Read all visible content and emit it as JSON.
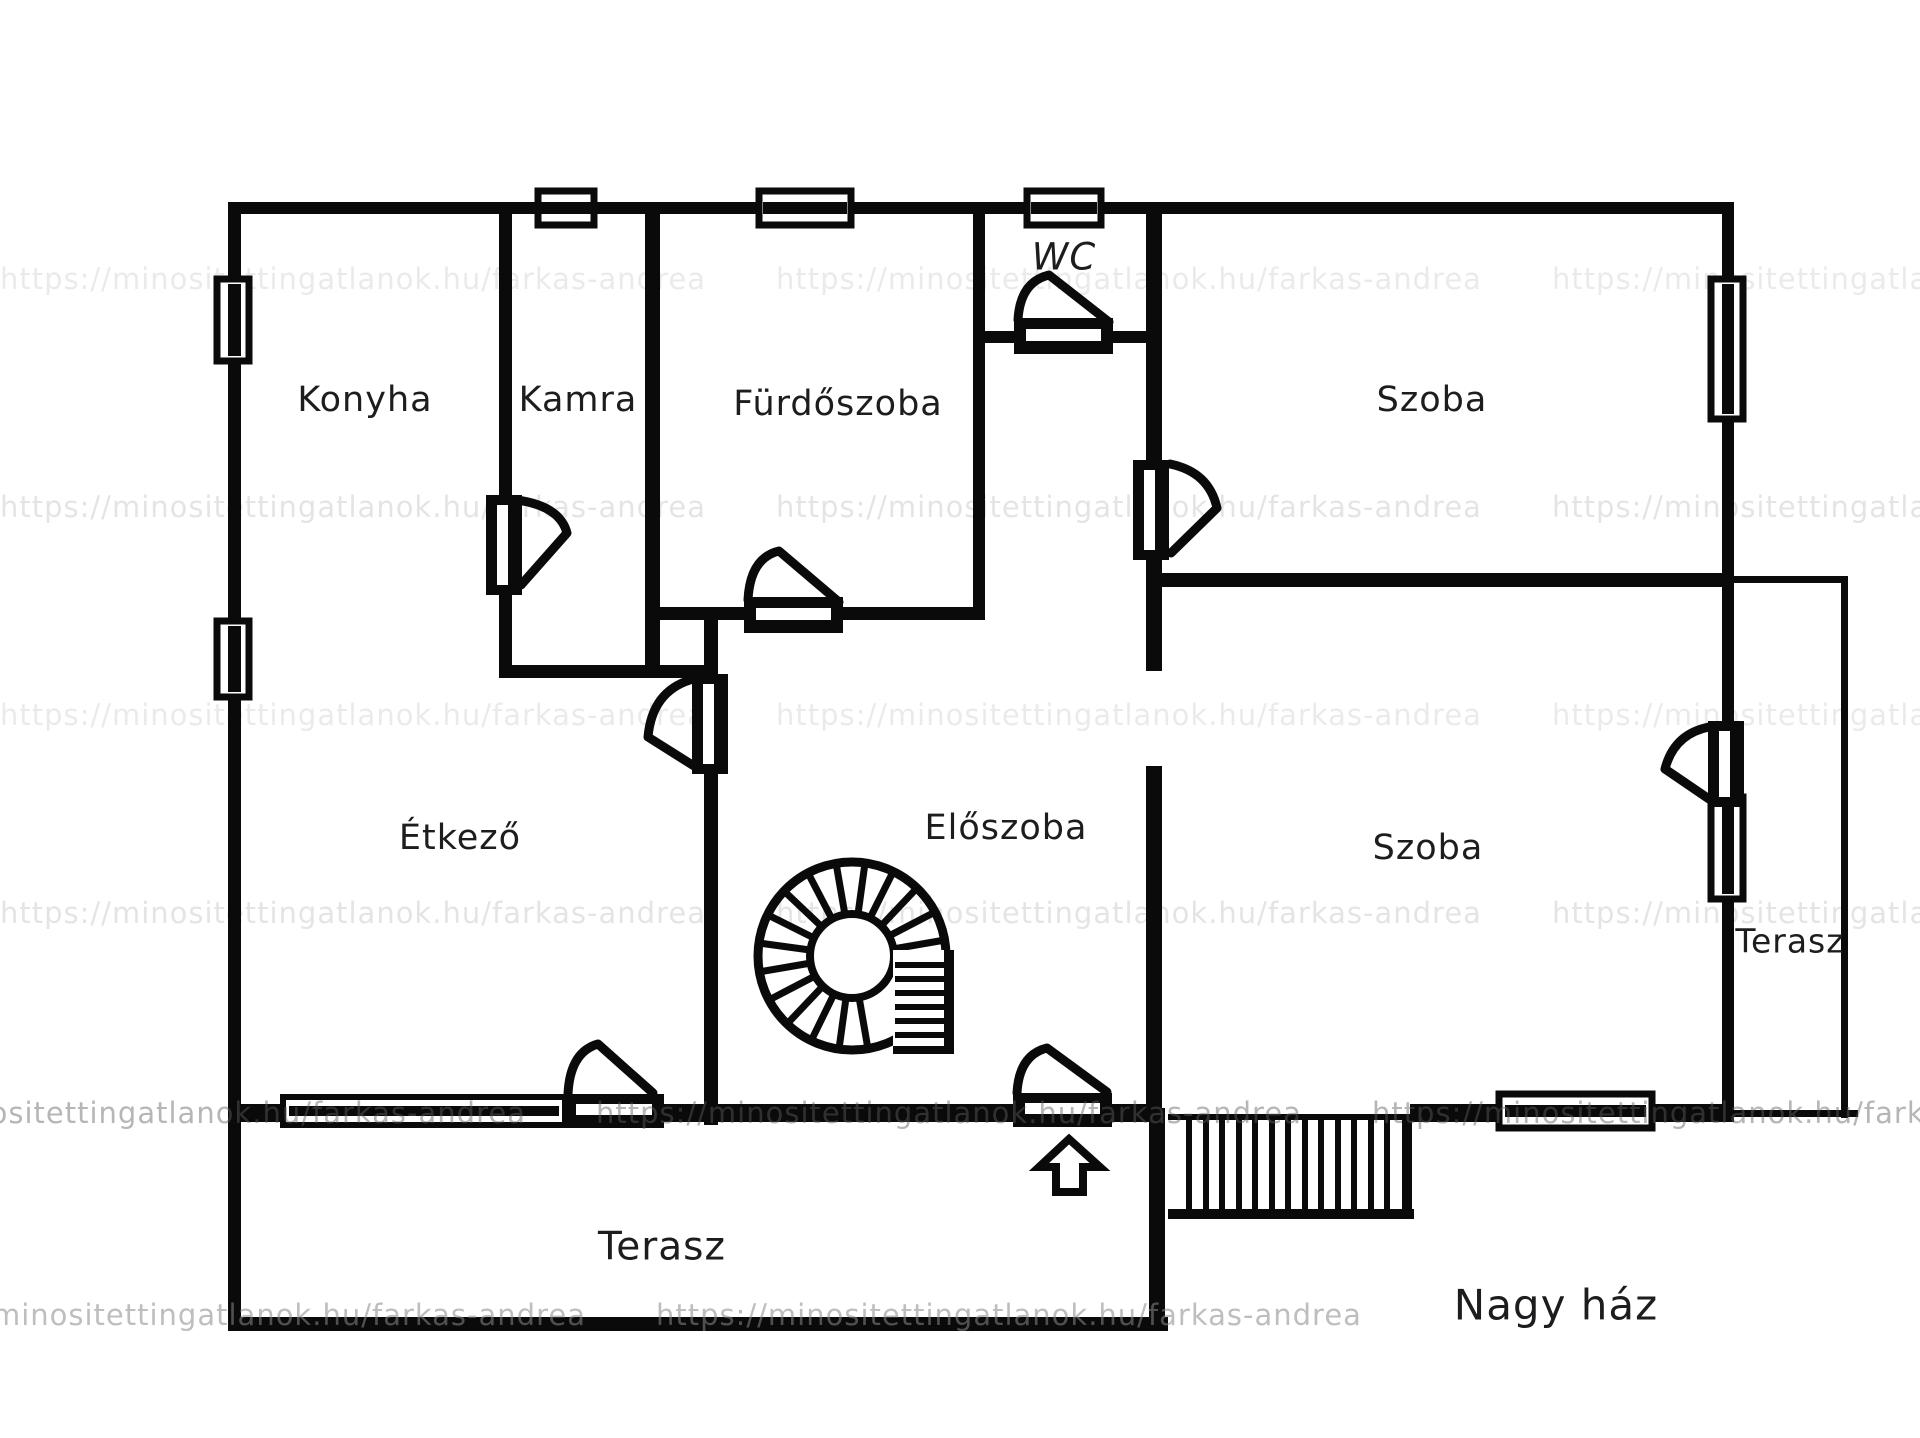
{
  "floor_plan": {
    "title": "Nagy ház",
    "rooms": [
      {
        "id": "konyha",
        "label": "Konyha"
      },
      {
        "id": "kamra",
        "label": "Kamra"
      },
      {
        "id": "furdoszoba",
        "label": "Fürdőszoba"
      },
      {
        "id": "wc",
        "label": "WC"
      },
      {
        "id": "szoba-felso",
        "label": "Szoba"
      },
      {
        "id": "etkezo",
        "label": "Étkező"
      },
      {
        "id": "eloszoba",
        "label": "Előszoba"
      },
      {
        "id": "szoba-also",
        "label": "Szoba"
      },
      {
        "id": "terasz-jobb",
        "label": "Terasz"
      },
      {
        "id": "terasz-also",
        "label": "Terasz"
      }
    ],
    "watermark": {
      "text": "https://minositettingatlanok.hu/farkas-andrea"
    },
    "colors": {
      "wall": "#0a0a0a",
      "background": "#ffffff",
      "label": "#1d1d1f",
      "watermark": "#5e5e66"
    }
  }
}
